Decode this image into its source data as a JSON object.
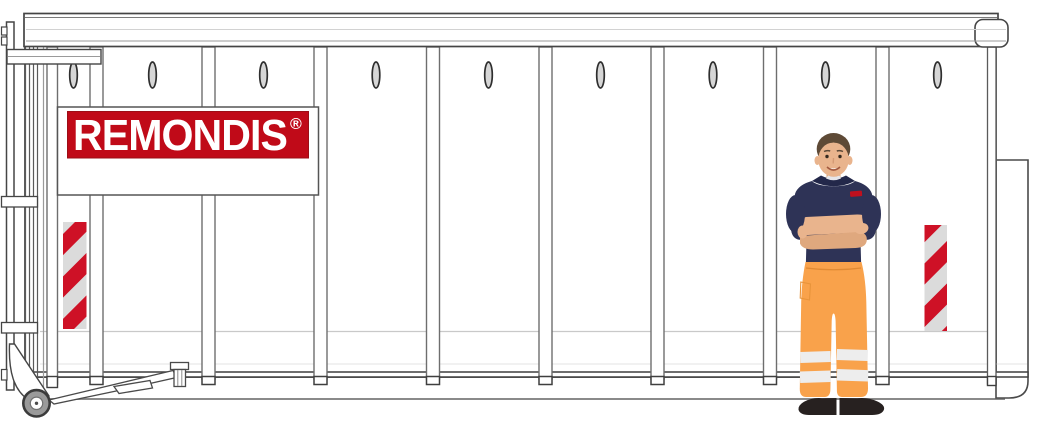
{
  "illustration": {
    "name": "remondis-roll-off-container-with-worker",
    "brand": {
      "label": "REMONDIS",
      "registered_mark": "®",
      "red": "#C00A18"
    },
    "container": {
      "panel_count": 9,
      "rib_count": 8,
      "vent_slot_count": 9,
      "warning_panel_count": 2,
      "colors": {
        "outline": "#4A4A4A",
        "line_mid": "#8A8A8A",
        "line_light": "#C9C9C9",
        "fill": "#FFFFFF",
        "warning_red": "#CE1126",
        "warning_silver": "#DBDBDB"
      }
    },
    "worker": {
      "shirt_navy": "#2E3356",
      "collar_navy": "#23284A",
      "pants_orange": "#F9A24B",
      "skin": "#E9B48D",
      "skin_shade": "#DFA87E",
      "hair": "#5E4A36",
      "shoes": "#272120",
      "reflective_stripe": "#EDEDED",
      "chest_logo_red": "#C0101E"
    }
  }
}
